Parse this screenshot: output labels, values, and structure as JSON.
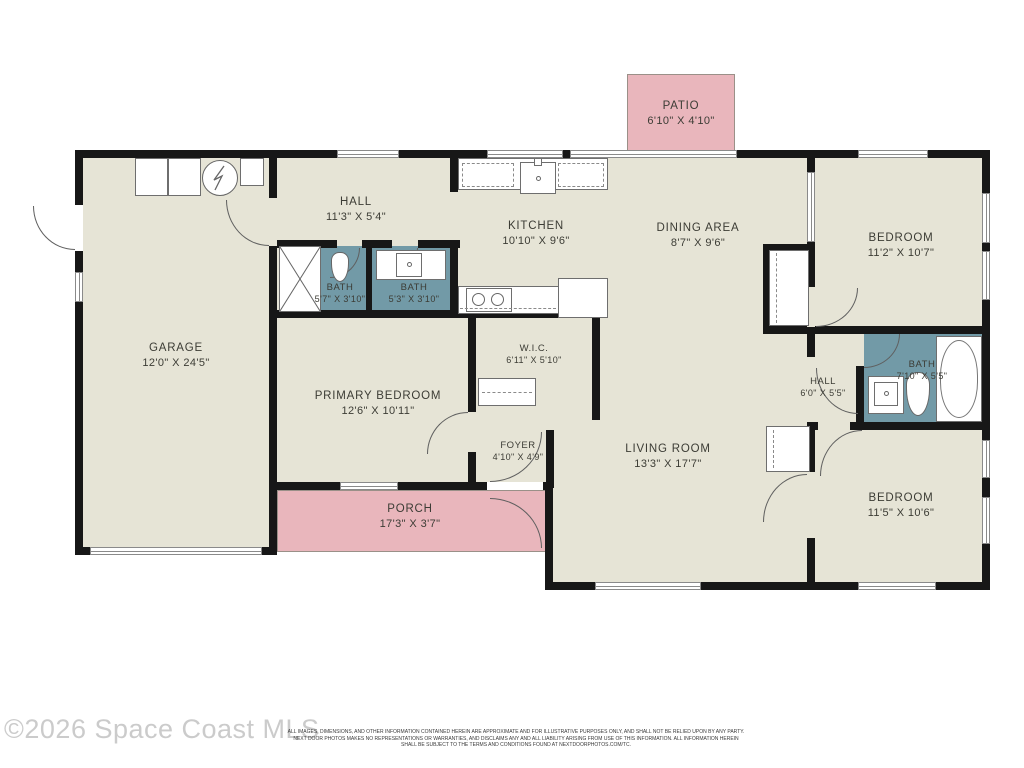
{
  "watermark": "©2026 Space Coast MLS",
  "disclaimer": {
    "line1": "ALL IMAGES, DIMENSIONS, AND OTHER INFORMATION CONTAINED HEREIN ARE APPROXIMATE AND FOR ILLUSTRATIVE PURPOSES ONLY, AND SHALL NOT BE RELIED UPON BY ANY PARTY.",
    "line2": "NEXT DOOR PHOTOS MAKES NO REPRESENTATIONS OR WARRANTIES, AND DISCLAIMS ANY AND ALL LIABILITY ARISING FROM USE OF THIS INFORMATION. ALL INFORMATION HEREIN",
    "line3": "SHALL BE SUBJECT TO THE TERMS AND CONDITIONS FOUND AT NEXTDOORPHOTOS.COM/TC."
  },
  "colors": {
    "floor": "#e6e4d6",
    "wall": "#171717",
    "bath": "#729aa7",
    "outdoor": "#e9b6bc"
  },
  "icons": {
    "water-heater": "circle-zigzag",
    "shower": "x-box",
    "closet-rod": "dashed-line"
  },
  "rooms": {
    "patio": {
      "name": "PATIO",
      "dims": "6'10\" X 4'10\""
    },
    "hall_top": {
      "name": "HALL",
      "dims": "11'3\" X 5'4\""
    },
    "kitchen": {
      "name": "KITCHEN",
      "dims": "10'10\" X 9'6\""
    },
    "dining": {
      "name": "DINING AREA",
      "dims": "8'7\" X 9'6\""
    },
    "bedroom_tr": {
      "name": "BEDROOM",
      "dims": "11'2\" X 10'7\""
    },
    "garage": {
      "name": "GARAGE",
      "dims": "12'0\" X 24'5\""
    },
    "bath_a": {
      "name": "BATH",
      "dims": "5'7\" X 3'10\""
    },
    "bath_b": {
      "name": "BATH",
      "dims": "5'3\" X 3'10\""
    },
    "wic": {
      "name": "W.I.C.",
      "dims": "6'11\" X 5'10\""
    },
    "primary": {
      "name": "PRIMARY BEDROOM",
      "dims": "12'6\" X 10'11\""
    },
    "foyer": {
      "name": "FOYER",
      "dims": "4'10\" X 4'9\""
    },
    "living": {
      "name": "LIVING ROOM",
      "dims": "13'3\" X 17'7\""
    },
    "hall_right": {
      "name": "HALL",
      "dims": "6'0\" X 5'5\""
    },
    "bath_c": {
      "name": "BATH",
      "dims": "7'10\" X 5'5\""
    },
    "bedroom_br": {
      "name": "BEDROOM",
      "dims": "11'5\" X 10'6\""
    },
    "porch": {
      "name": "PORCH",
      "dims": "17'3\" X 3'7\""
    }
  }
}
